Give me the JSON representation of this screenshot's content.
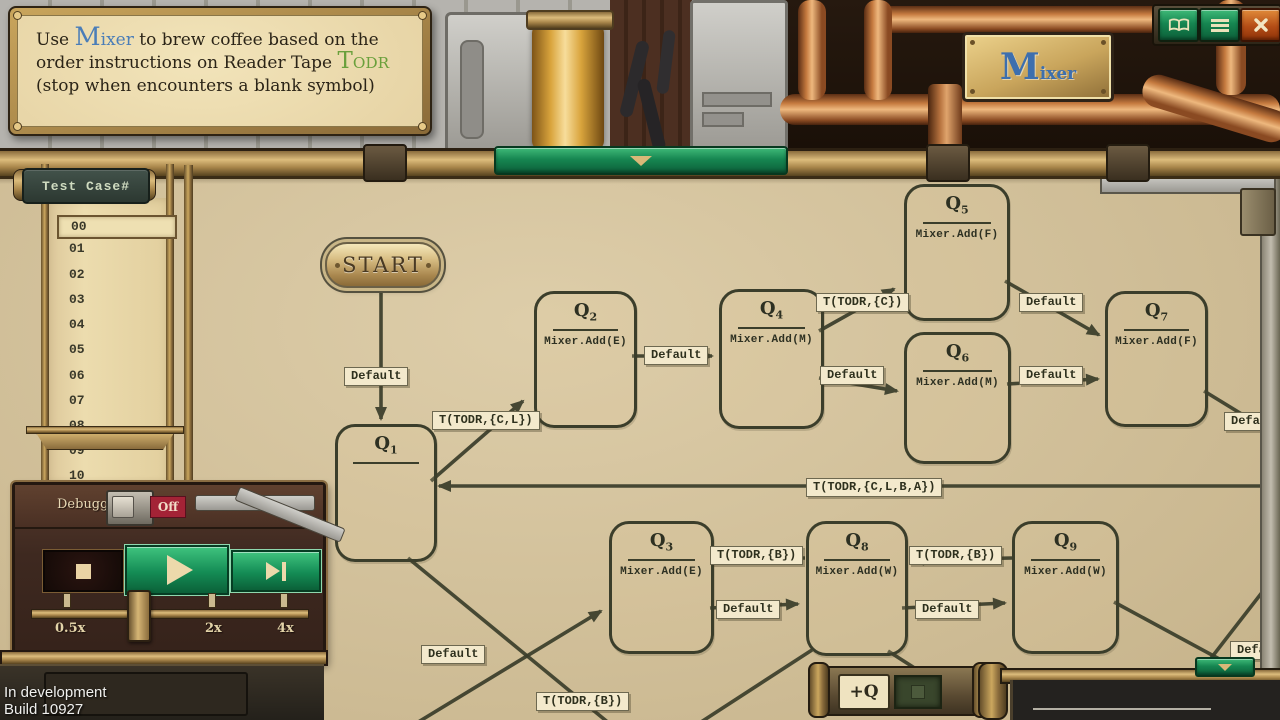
{
  "window": {
    "machine_plaque": {
      "initial": "M",
      "rest": "ixer"
    },
    "buttons": [
      {
        "name": "manual",
        "icon": "open-book-icon"
      },
      {
        "name": "menu",
        "icon": "hamburger-menu-icon"
      },
      {
        "name": "close",
        "icon": "close-x-icon"
      }
    ]
  },
  "instruction": {
    "prefix": "Use ",
    "device_keyword": "Mixer",
    "middle": " to brew coffee based on the order instructions on Reader Tape ",
    "tape_keyword": "TODR",
    "suffix": " (stop when encounters a blank symbol)"
  },
  "test_panel": {
    "title": "Test Case#",
    "items": [
      "00",
      "01",
      "02",
      "03",
      "04",
      "05",
      "06",
      "07",
      "08",
      "09",
      "10"
    ],
    "selected": "00"
  },
  "debugger": {
    "label": "Debugger",
    "toggle_state": "Off",
    "transport_icons": [
      "stop-square",
      "play-triangle",
      "step-forward"
    ],
    "speeds": [
      "0.5x",
      "2x",
      "4x"
    ]
  },
  "diagram": {
    "start_label": "START",
    "state_letter": "Q",
    "add_state_button": "+Q",
    "states": [
      {
        "id": "Q1",
        "sub": "1",
        "action": ""
      },
      {
        "id": "Q2",
        "sub": "2",
        "action": "Mixer.Add(E)"
      },
      {
        "id": "Q3",
        "sub": "3",
        "action": "Mixer.Add(E)"
      },
      {
        "id": "Q4",
        "sub": "4",
        "action": "Mixer.Add(M)"
      },
      {
        "id": "Q5",
        "sub": "5",
        "action": "Mixer.Add(F)"
      },
      {
        "id": "Q6",
        "sub": "6",
        "action": "Mixer.Add(M)"
      },
      {
        "id": "Q7",
        "sub": "7",
        "action": "Mixer.Add(F)"
      },
      {
        "id": "Q8",
        "sub": "8",
        "action": "Mixer.Add(W)"
      },
      {
        "id": "Q9",
        "sub": "9",
        "action": "Mixer.Add(W)"
      }
    ],
    "transitions": [
      {
        "from": "START",
        "to": "Q1",
        "label": "Default"
      },
      {
        "from": "Q1",
        "to": "Q2",
        "label": "T(TODR,{C,L})"
      },
      {
        "from": "Q2",
        "to": "Q4",
        "label": "Default"
      },
      {
        "from": "Q4",
        "to": "Q5",
        "label": "T(TODR,{C})"
      },
      {
        "from": "Q4",
        "to": "Q6",
        "label": "Default"
      },
      {
        "from": "Q5",
        "to": "Q7",
        "label": "Default"
      },
      {
        "from": "Q6",
        "to": "Q7",
        "label": "Default"
      },
      {
        "from": "Q7",
        "to": "offscreen-right",
        "label": "Default"
      },
      {
        "from": "offscreen-right",
        "to": "Q1",
        "label": "T(TODR,{C,L,B,A})"
      },
      {
        "from": "Q8",
        "to": "Q3",
        "label": "T(TODR,{B})"
      },
      {
        "from": "Q3",
        "to": "Q8",
        "label": "Default"
      },
      {
        "from": "Q9",
        "to": "Q8",
        "label": "T(TODR,{B})"
      },
      {
        "from": "Q8",
        "to": "Q9",
        "label": "Default"
      },
      {
        "from": "Q1",
        "to": "offscreen-bottom",
        "label": "T(TODR,{B})"
      },
      {
        "from": "offscreen-bottom",
        "to": "Q3",
        "label": "Default"
      },
      {
        "from": "Q9",
        "to": "offscreen-bottom-right",
        "label": "Default"
      }
    ]
  },
  "footer": {
    "line1": "In development",
    "line2": "Build 10927"
  },
  "colors": {
    "parchment": "#d7c49a",
    "ink": "#3b3e2b",
    "label_chip": "#f3e9cc",
    "brass": "#c9a55c",
    "accent_green": "#168651",
    "close_orange": "#c1551c",
    "toggle_off_red": "#a32336",
    "keyword_blue": "#4a7db8",
    "keyword_green": "#6aa03c"
  }
}
